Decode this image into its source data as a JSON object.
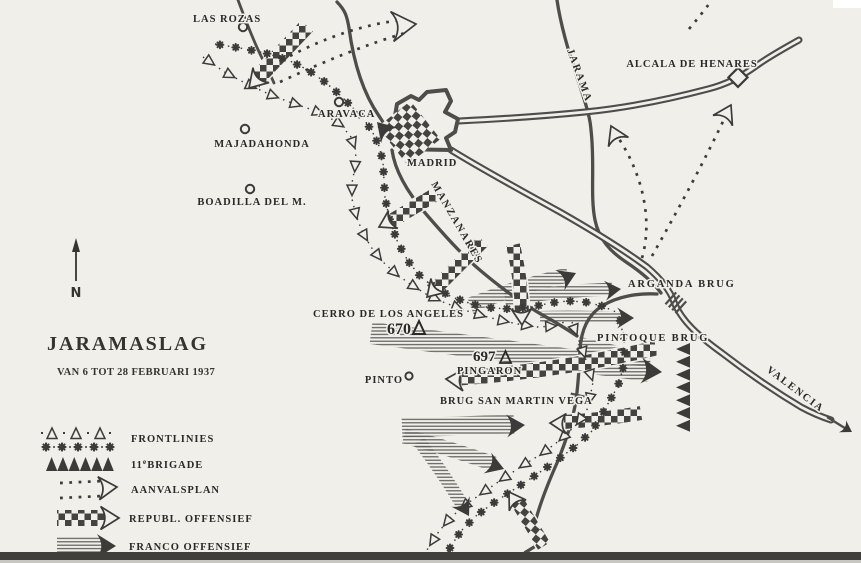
{
  "map": {
    "colors": {
      "paper": "#f1efe9",
      "ink": "#3c3b39",
      "line": "#4e4d4a"
    },
    "title": "JARAMASLAG",
    "subtitle": "VAN 6 TOT 28 FEBRUARI 1937",
    "compass": "N",
    "legend": {
      "frontlines": "FRONTLINIES",
      "brigade_prefix": "11",
      "brigade_sup": "e",
      "brigade_rest": "BRIGADE",
      "aanvalsplan": "AANVALSPLAN",
      "republ": "REPUBL. OFFENSIEF",
      "franco": "FRANCO OFFENSIEF"
    },
    "places": {
      "las_rozas": "LAS ROZAS",
      "aravaca": "ARAVACA",
      "majadahonda": "MAJADAHONDA",
      "boadilla": "BOADILLA DEL M.",
      "madrid": "MADRID",
      "pinto": "PINTO",
      "alcala": "ALCALA DE HENARES"
    },
    "rivers": {
      "manzanares": "MANZANARES",
      "jarama": "JARAMA"
    },
    "bridges": {
      "arganda": "ARGANDA BRUG",
      "pintoque": "PINTOQUE BRUG",
      "san_martin": "BRUG SAN MARTIN VEGA"
    },
    "peaks": {
      "cerro": "CERRO DE LOS ANGELES",
      "cerro_elev": "670",
      "pingaron": "PINGARON",
      "pingaron_elev": "697"
    },
    "routes": {
      "valencia": "VALENCIA"
    }
  }
}
